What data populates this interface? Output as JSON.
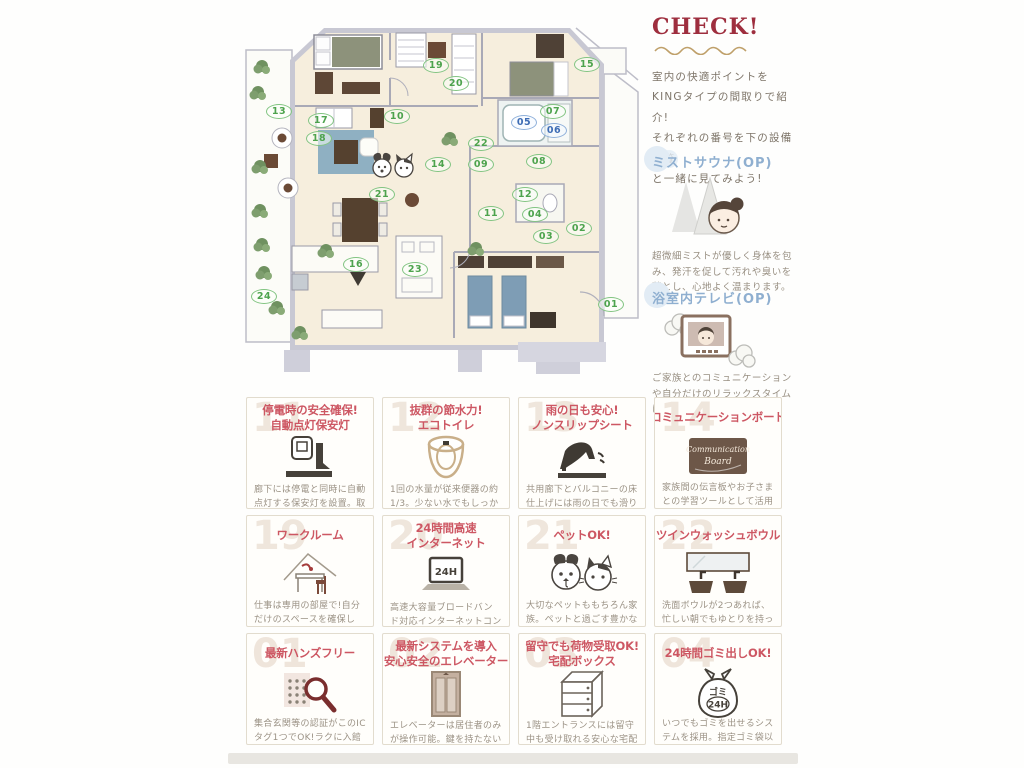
{
  "check_panel": {
    "title": "CHECK!",
    "intro_lines": [
      "室内の快適ポイントを",
      "KINGタイプの間取りで紹介!",
      "それぞれの番号を下の設備一覧",
      "と一緒に見てみよう!"
    ]
  },
  "op_features": [
    {
      "title": "ミストサウナ(OP)",
      "icon": "mist-sauna",
      "desc": "超微細ミストが優しく身体を包み、発汗を促して汚れや臭いを落とし、心地よく温まります。"
    },
    {
      "title": "浴室内テレビ(OP)",
      "icon": "bath-tv",
      "desc": "ご家族とのコミュニケーションや自分だけのリラックスタイムに一役買います。"
    }
  ],
  "floorplan": {
    "markers": [
      {
        "n": "01",
        "x": 381,
        "y": 285,
        "c": "green"
      },
      {
        "n": "02",
        "x": 349,
        "y": 209,
        "c": "green"
      },
      {
        "n": "03",
        "x": 316,
        "y": 217,
        "c": "green"
      },
      {
        "n": "04",
        "x": 305,
        "y": 195,
        "c": "green"
      },
      {
        "n": "05",
        "x": 294,
        "y": 103,
        "c": "blue"
      },
      {
        "n": "06",
        "x": 324,
        "y": 111,
        "c": "blue"
      },
      {
        "n": "07",
        "x": 323,
        "y": 92,
        "c": "green"
      },
      {
        "n": "08",
        "x": 309,
        "y": 142,
        "c": "green"
      },
      {
        "n": "09",
        "x": 251,
        "y": 145,
        "c": "green"
      },
      {
        "n": "10",
        "x": 167,
        "y": 97,
        "c": "green"
      },
      {
        "n": "11",
        "x": 261,
        "y": 194,
        "c": "green"
      },
      {
        "n": "12",
        "x": 295,
        "y": 175,
        "c": "green"
      },
      {
        "n": "13",
        "x": 49,
        "y": 92,
        "c": "green"
      },
      {
        "n": "14",
        "x": 208,
        "y": 145,
        "c": "green"
      },
      {
        "n": "15",
        "x": 357,
        "y": 45,
        "c": "green"
      },
      {
        "n": "16",
        "x": 126,
        "y": 245,
        "c": "green"
      },
      {
        "n": "17",
        "x": 91,
        "y": 101,
        "c": "green"
      },
      {
        "n": "18",
        "x": 89,
        "y": 119,
        "c": "green"
      },
      {
        "n": "19",
        "x": 206,
        "y": 46,
        "c": "green"
      },
      {
        "n": "20",
        "x": 226,
        "y": 64,
        "c": "green"
      },
      {
        "n": "21",
        "x": 152,
        "y": 175,
        "c": "green"
      },
      {
        "n": "22",
        "x": 251,
        "y": 124,
        "c": "green"
      },
      {
        "n": "23",
        "x": 185,
        "y": 250,
        "c": "green"
      },
      {
        "n": "24",
        "x": 34,
        "y": 277,
        "c": "green"
      }
    ]
  },
  "labels": {
    "laptop": "24H",
    "garbage_line1": "ゴミ",
    "garbage_line2": "24H",
    "board_line1": "Communication",
    "board_line2": "Board"
  },
  "features": [
    {
      "ghost": "11",
      "title_lines": [
        "停電時の安全確保!",
        "自動点灯保安灯"
      ],
      "icon": "emergency-light",
      "desc": "廊下には停電と同時に自動点灯する保安灯を設置。取り外せば懐中電灯にもなります。",
      "note": ""
    },
    {
      "ghost": "12",
      "title_lines": [
        "抜群の節水力!",
        "エコトイレ"
      ],
      "icon": "eco-toilet",
      "desc": "1回の水量が従来便器の約1/3。少ない水でもしっかり汚れを流し水道代もお得です。",
      "note": ""
    },
    {
      "ghost": "13",
      "title_lines": [
        "雨の日も安心!",
        "ノンスリップシート"
      ],
      "icon": "nonslip",
      "desc": "共用廊下とバルコニーの床仕上げには雨の日でも滑りにくいノンスリップシートを採用。",
      "note": ""
    },
    {
      "ghost": "14",
      "title_lines": [
        "コミュニケーションボード"
      ],
      "icon": "communication-board",
      "desc": "家族間の伝言板やお子さまとの学習ツールとして活用できるボードです。",
      "note": ""
    },
    {
      "ghost": "19",
      "title_lines": [
        "ワークルーム"
      ],
      "icon": "workroom",
      "desc": "仕事は専用の部屋で!自分だけのスペースを確保して、作業の効率化を図ります。",
      "note": ""
    },
    {
      "ghost": "20",
      "title_lines": [
        "24時間高速",
        "インターネット"
      ],
      "icon": "internet",
      "desc": "高速大容量ブロードバンド対応インターネットコンセントをリビングとワークルームに配置。",
      "note": ""
    },
    {
      "ghost": "21",
      "title_lines": [
        "ペットOK!"
      ],
      "icon": "pets",
      "desc": "大切なペットももちろん家族。ペットと過ごす豊かな生活をエンジョイ!",
      "note": ""
    },
    {
      "ghost": "22",
      "title_lines": [
        "ツインウォッシュボウル"
      ],
      "icon": "twin-bowl",
      "desc": "洗面ボウルが2つあれば、忙しい朝でもゆとりを持って身支度ができます。",
      "note": "※KINGタイプのみ"
    },
    {
      "ghost": "01",
      "title_lines": [
        "最新ハンズフリー"
      ],
      "icon": "handsfree",
      "desc": "集合玄関等の認証がこのICタグ1つでOK!ラクに入館することが出来ます。",
      "note": ""
    },
    {
      "ghost": "02",
      "title_lines": [
        "最新システムを導入",
        "安心安全のエレベーター"
      ],
      "icon": "elevator",
      "desc": "エレベーターは居住者のみが操作可能。鍵を持たない不審者の侵入を防ぎます。",
      "note": ""
    },
    {
      "ghost": "03",
      "title_lines": [
        "留守でも荷物受取OK!",
        "宅配ボックス"
      ],
      "icon": "delivery-box",
      "desc": "1階エントランスには留守中も受け取れる安心な宅配ボックスを設置。",
      "note": ""
    },
    {
      "ghost": "04",
      "title_lines": [
        "24時間ゴミ出しOK!"
      ],
      "icon": "garbage",
      "desc": "いつでもゴミを出せるシステムを採用。指定ゴミ袋以外の袋もOKだから経済的!",
      "note": ""
    }
  ]
}
